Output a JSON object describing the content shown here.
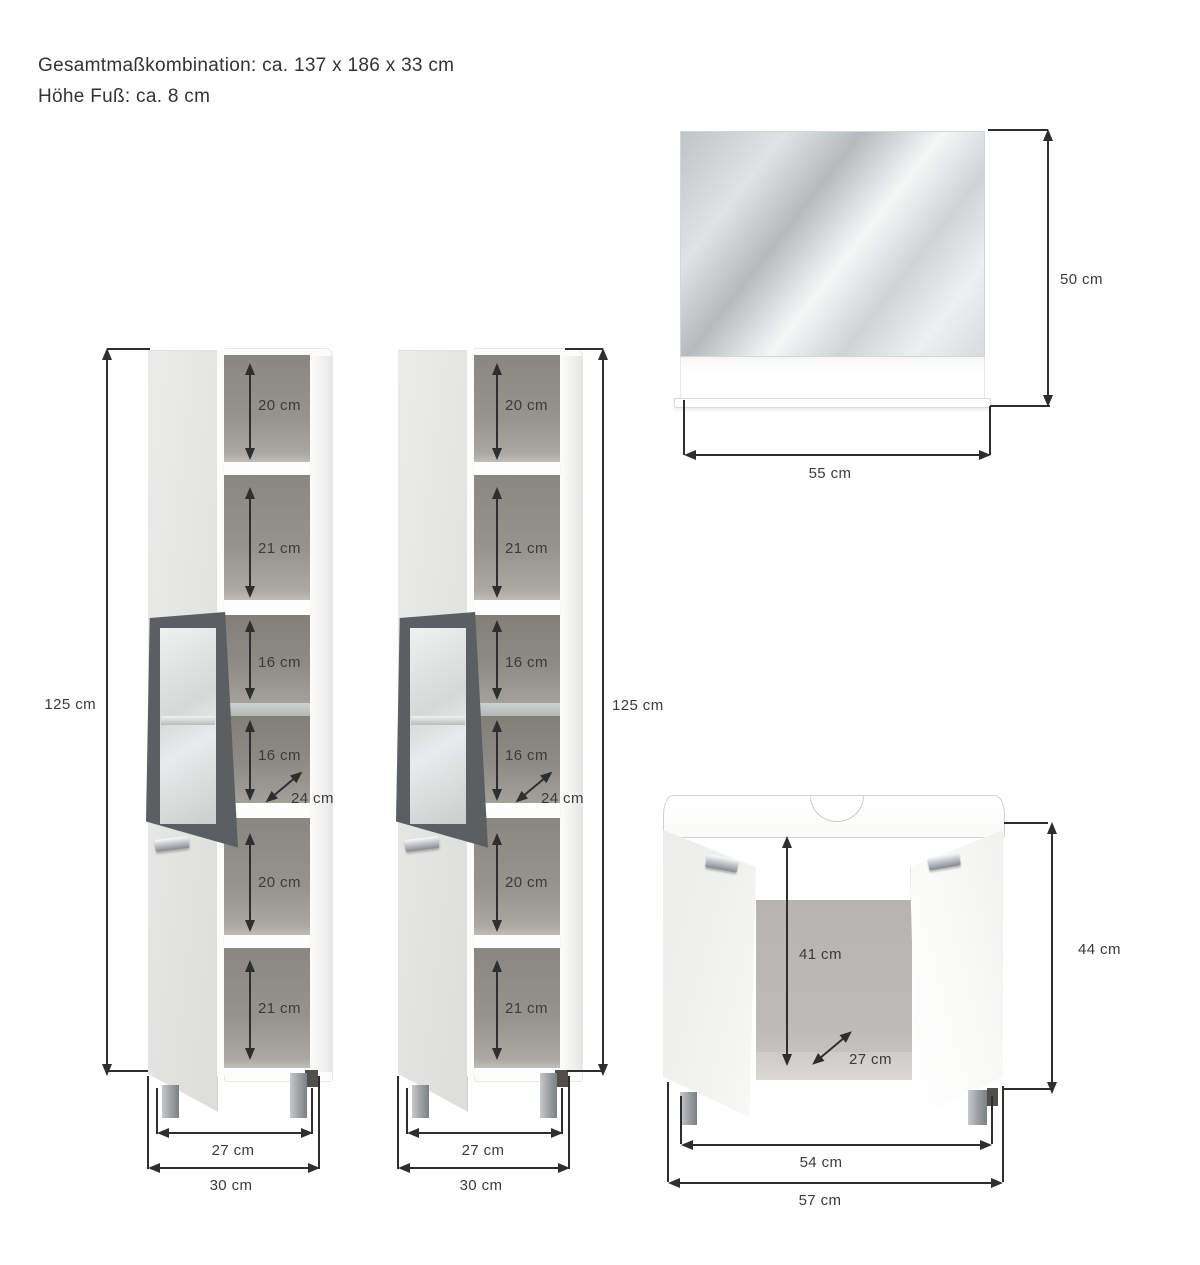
{
  "title_block": {
    "line1": "Gesamtmaßkombination: ca. 137 x 186 x 33 cm",
    "line2": "Höhe Fuß: ca. 8 cm"
  },
  "tall_cabinet_left": {
    "height": "125 cm",
    "compartments": [
      "20 cm",
      "21 cm",
      "16 cm",
      "16 cm",
      "20 cm",
      "21 cm"
    ],
    "depth": "24 cm",
    "inner_width": "27 cm",
    "outer_width": "30 cm"
  },
  "tall_cabinet_right": {
    "height": "125 cm",
    "compartments": [
      "20 cm",
      "21 cm",
      "16 cm",
      "16 cm",
      "20 cm",
      "21 cm"
    ],
    "depth": "24 cm",
    "inner_width": "27 cm",
    "outer_width": "30 cm"
  },
  "mirror": {
    "height": "50 cm",
    "width": "55 cm"
  },
  "sink_cabinet": {
    "inner_height": "41 cm",
    "depth": "27 cm",
    "height": "44 cm",
    "inner_width": "54 cm",
    "outer_width": "57 cm"
  },
  "colors": {
    "dimension_line": "#2e2e2e",
    "label_text": "#3b3b3b",
    "door_gray": "#e6e6e5",
    "interior_gray": "#8c8a84",
    "glass_frame_gray": "#5c5f62",
    "chrome_handle": "#c6c8ca",
    "leg_gray": "#a0a2a5",
    "mirror_gray": "#c9cdce"
  }
}
